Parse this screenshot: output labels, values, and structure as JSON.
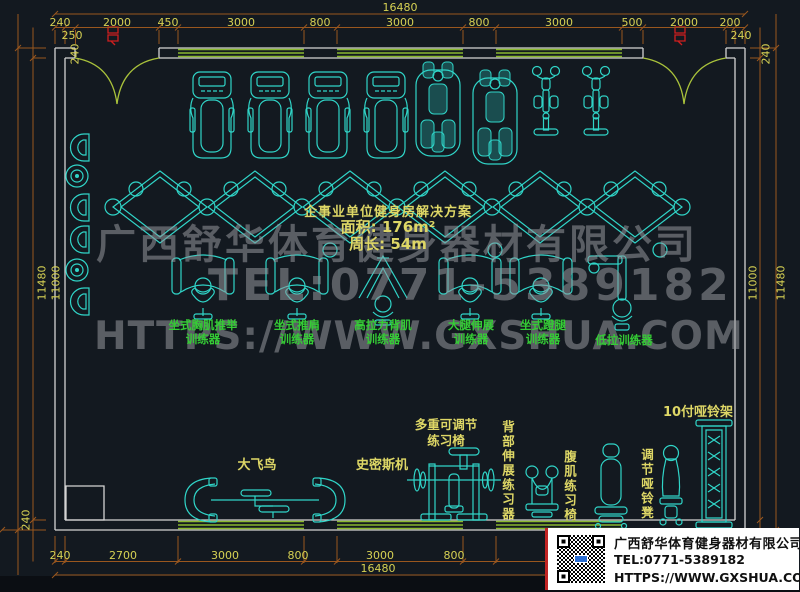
{
  "title_block": {
    "line1": "企事业单位健身房解决方案",
    "line2": "面积: 176m²",
    "line3": "周长: 54m"
  },
  "watermark": {
    "company": "广西舒华体育健身器材有限公司",
    "tel": "TEL:0771-5389182",
    "url": "HTTPS://WWW.GXSHUA.COM"
  },
  "info_card": {
    "company": "广西舒华体育健身器材有限公司",
    "tel": "TEL:0771-5389182",
    "url": "HTTPS://WWW.GXSHUA.COM"
  },
  "dims": {
    "top": {
      "overall": "16480",
      "segments": [
        "240",
        "2000",
        "450",
        "3000",
        "800",
        "3000",
        "800",
        "3000",
        "500",
        "2000",
        "200"
      ],
      "sub_left": "250",
      "sub_right": "240"
    },
    "bottom": {
      "overall": "16480",
      "segments": [
        "240",
        "2700",
        "3000",
        "800",
        "3000",
        "800"
      ]
    },
    "left": {
      "top": "240",
      "outer": "11480",
      "inner": "11000",
      "bottom": "240"
    },
    "right": {
      "top": "240",
      "outer": "11480",
      "inner": "11000"
    }
  },
  "equipment_labels": {
    "mid": [
      {
        "text": "坐式胸肌推举\n训练器"
      },
      {
        "text": "坐式推肩\n训练器"
      },
      {
        "text": "高拉力背肌\n训练器"
      },
      {
        "text": "大腿伸展\n训练器"
      },
      {
        "text": "坐式蹬腿\n训练器"
      },
      {
        "text": "低拉训练器"
      }
    ],
    "bottom": [
      {
        "text": "大飞鸟"
      },
      {
        "text": "史密斯机"
      },
      {
        "text": "多重可调节\n练习椅"
      },
      {
        "text": "背部伸展练习器"
      },
      {
        "text": "腹肌练习椅"
      },
      {
        "text": "调节哑铃凳"
      },
      {
        "text": "10付哑铃架"
      }
    ]
  },
  "colors": {
    "background": "#131920",
    "dimension_line": "#9a571e",
    "dimension_text": "#d6d153",
    "equipment_cyan": "#30d5c8",
    "label_green": "#35cc35",
    "label_yellow": "#ded766",
    "wall_gray": "#d4d4d4",
    "window_green": "#8ab82f",
    "door_green": "#a9c23b",
    "watermark_gray": "#96989c",
    "door_tag_red": "#cf1f1f"
  }
}
